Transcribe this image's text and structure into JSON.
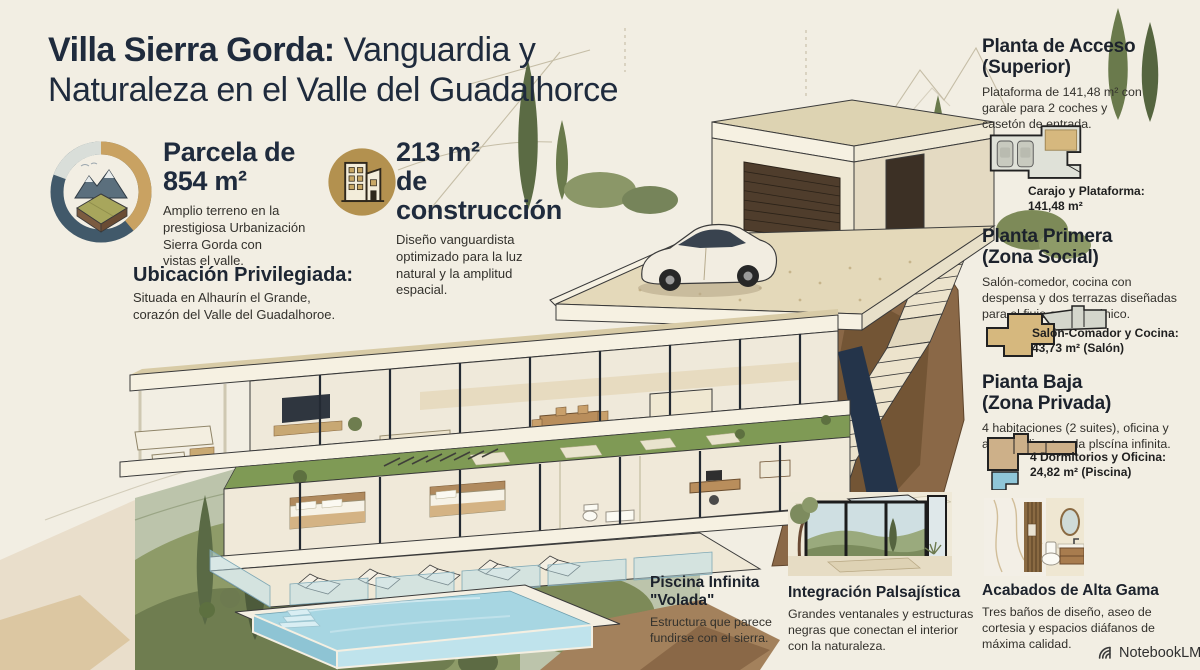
{
  "title": {
    "bold": "Villa Sierra Gorda:",
    "rest": " Vanguardia y Naturaleza en el Valle del Guadalhorce"
  },
  "stats": [
    {
      "icon": "parcel-donut-icon",
      "heading": "Parcela de\n854 m²",
      "body": "Amplio terreno en la\nprestigiosa Urbanización\nSierra Gorda con\nvistas el valle."
    },
    {
      "icon": "building-icon",
      "heading": "213 m²\nde construcción",
      "body": "Diseño vanguardista\noptimizado para la luz\nnatural y la amplitud\nespacial."
    }
  ],
  "location": {
    "heading": "Ubicación Privilegiada:",
    "body": "Situada en Alhaurín el Grande,\ncorazón del Valle del Guadalhoroe."
  },
  "right_sections": [
    {
      "heading": "Planta de Acceso\n(Superior)",
      "body": "Plataforma de 141,48 m² con\ngarale para 2 coches y\ncasetón de entrada.",
      "caption": "Carajo y Plataforma:\n141,48 m²",
      "diagram": "access-floor-plan"
    },
    {
      "heading": "Planta Primera\n(Zona Social)",
      "body": "Salón-comedor, cocina con\ndespensa y dos terrazas diseñadas\npara el fiujo arquitectónico.",
      "caption": "Salón-Comador y Cocina:\n43,73 m² (Salón)",
      "diagram": "social-floor-plan"
    },
    {
      "heading": "Pianta Baja\n(Zona Privada)",
      "body": "4 habitaciones (2 suites), oficina y\nacceso directo a la plscína infinita.",
      "caption": "4 Dormitorios y Oficina:\n24,82 m² (Piscina)",
      "diagram": "private-floor-plan"
    }
  ],
  "bottom_notes": [
    {
      "heading": "Piscina Infinita\n\"Volada\"",
      "body": "Estructura que parece\nfundirse con el sierra."
    },
    {
      "heading": "Integración Palsajística",
      "body": "Grandes ventanales y estructuras\nnegras que conectan el interior\ncon la naturaleza.",
      "image": "window-landscape-illustration"
    },
    {
      "heading": "Acabados de Alta Gama",
      "body": "Tres baños de diseño, aseo de\ncortesia y espacios diáfanos de\nmáxima calidad.",
      "image": "bathroom-illustration"
    }
  ],
  "brand": {
    "label": "NotebookLM",
    "icon": "notebooklm-logo-icon"
  },
  "colors": {
    "background": "#f2eee3",
    "title_navy": "#1f2b3d",
    "accent_gold": "#b3914f",
    "donut_slate": "#41596a",
    "donut_gold": "#c9a262",
    "pool_blue": "#a7d6e2",
    "olive_green": "#8e9b68",
    "cliff_brown": "#8a6847"
  }
}
